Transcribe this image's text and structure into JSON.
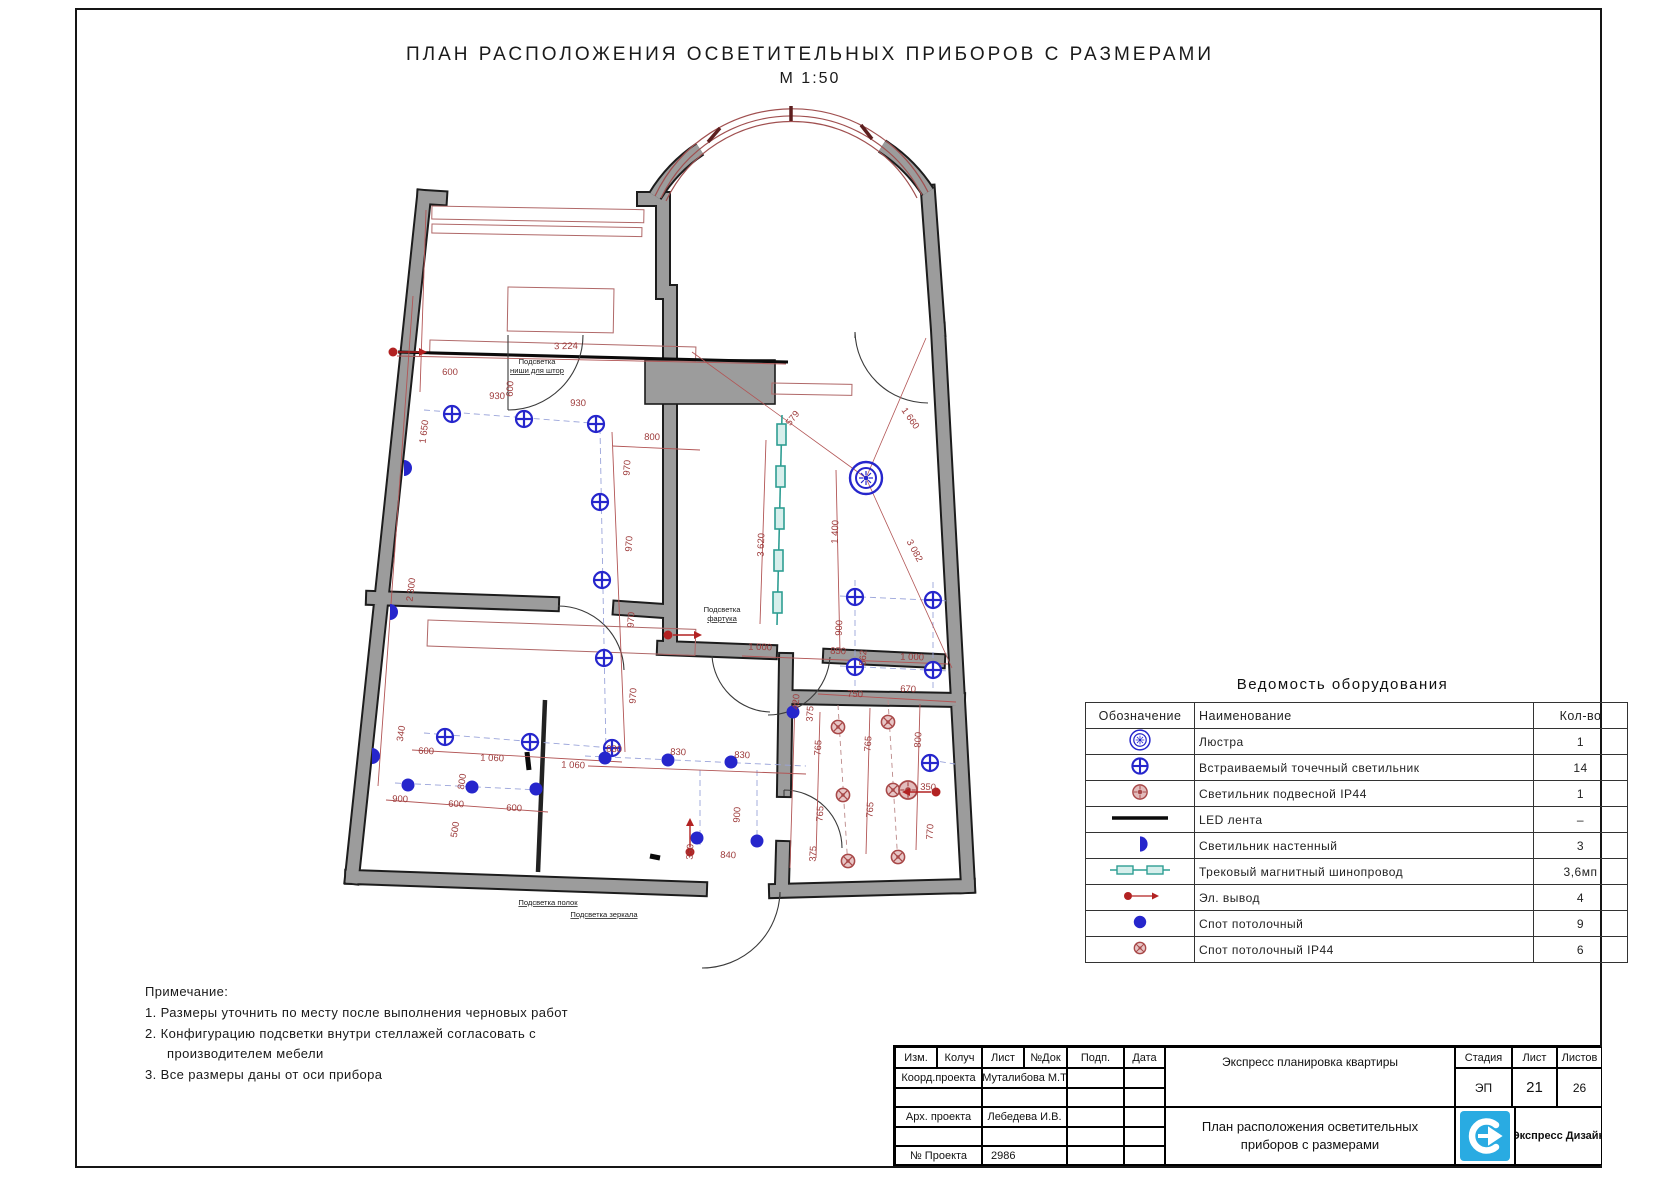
{
  "sheet": {
    "title": "ПЛАН РАСПОЛОЖЕНИЯ ОСВЕТИТЕЛЬНЫХ ПРИБОРОВ С РАЗМЕРАМИ",
    "scale": "М 1:50"
  },
  "colors": {
    "symbol_blue": "#2626cc",
    "dim_red": "#9e3c3c",
    "ip44_red": "#a84848",
    "track_teal": "#2f9e93",
    "wall_gray": "#9c9c9c",
    "logo_blue": "#29abe2"
  },
  "equipment_table": {
    "title": "Ведомость оборудования",
    "columns": [
      "Обозначение",
      "Наименование",
      "Кол-во"
    ],
    "rows": [
      {
        "icon": "chandelier",
        "name": "Люстра",
        "qty": "1"
      },
      {
        "icon": "recessed",
        "name": "Встраиваемый точечный светильник",
        "qty": "14"
      },
      {
        "icon": "pendant-ip44",
        "name": "Светильник подвесной IP44",
        "qty": "1"
      },
      {
        "icon": "led",
        "name": "LED лента",
        "qty": "–"
      },
      {
        "icon": "wall-light",
        "name": "Светильник настенный",
        "qty": "3"
      },
      {
        "icon": "track",
        "name": "Трековый магнитный шинопровод",
        "qty": "3,6мп"
      },
      {
        "icon": "outlet",
        "name": "Эл. вывод",
        "qty": "4"
      },
      {
        "icon": "spot",
        "name": "Спот потолочный",
        "qty": "9"
      },
      {
        "icon": "spot-ip44",
        "name": "Спот потолочный IP44",
        "qty": "6"
      }
    ]
  },
  "notes": {
    "title": "Примечание:",
    "line1": "1. Размеры уточнить по месту после выполнения черновых работ",
    "line2a": "2. Конфигурацию подсветки внутри стеллажей согласовать с",
    "line2b": "производителем мебели",
    "line3": "3. Все размеры даны от оси прибора"
  },
  "title_block": {
    "h1": "Изм.",
    "h2": "Колуч",
    "h3": "Лист",
    "h4": "№Док",
    "h5": "Подп.",
    "h6": "Дата",
    "r2l": "Коорд.проекта",
    "r2v": "Муталибова М.Т",
    "r4l": "Арх. проекта",
    "r4v": "Лебедева И.В.",
    "r6l": "№ Проекта",
    "r6v": "2986",
    "top_title": "Экспресс планировка квартиры",
    "stage": "Стадия",
    "sheet": "Лист",
    "sheets": "Листов",
    "stage_v": "ЭП",
    "sheet_v": "21",
    "sheets_v": "26",
    "doc1": "План расположения осветительных",
    "doc2": "приборов с размерами",
    "brand": "Экспресс Дизайн"
  },
  "plan": {
    "dims": [
      [
        "3 224",
        566,
        349,
        -1
      ],
      [
        "600",
        450,
        375,
        0
      ],
      [
        "930",
        497,
        399,
        1
      ],
      [
        "930",
        578,
        406,
        1
      ],
      [
        "600",
        513,
        389,
        -87
      ],
      [
        "1 650",
        427,
        432,
        -83
      ],
      [
        "800",
        652,
        440,
        1
      ],
      [
        "970",
        630,
        468,
        -86
      ],
      [
        "970",
        632,
        544,
        -86
      ],
      [
        "970",
        634,
        620,
        -86
      ],
      [
        "970",
        636,
        696,
        -86
      ],
      [
        "2 300",
        414,
        590,
        -83
      ],
      [
        "340",
        404,
        734,
        -81
      ],
      [
        "600",
        426,
        754,
        2
      ],
      [
        "1 060",
        492,
        761,
        2
      ],
      [
        "1 060",
        573,
        768,
        2
      ],
      [
        "800",
        465,
        782,
        -81
      ],
      [
        "500",
        458,
        830,
        -81
      ],
      [
        "900",
        400,
        802,
        2
      ],
      [
        "600",
        456,
        807,
        2
      ],
      [
        "600",
        514,
        811,
        2
      ],
      [
        "830",
        614,
        752,
        2
      ],
      [
        "830",
        678,
        755,
        2
      ],
      [
        "830",
        742,
        758,
        2
      ],
      [
        "900",
        740,
        815,
        -86
      ],
      [
        "350",
        693,
        852,
        -86
      ],
      [
        "840",
        728,
        858,
        2
      ],
      [
        "1 000",
        760,
        650,
        2
      ],
      [
        "850",
        838,
        654,
        2
      ],
      [
        "562",
        866,
        658,
        -86
      ],
      [
        "1 000",
        912,
        660,
        2
      ],
      [
        "3 620",
        764,
        545,
        -88
      ],
      [
        "1 400",
        838,
        532,
        -88
      ],
      [
        "900",
        842,
        628,
        -88
      ],
      [
        "579",
        795,
        420,
        -52
      ],
      [
        "1 660",
        908,
        420,
        55
      ],
      [
        "3 082",
        912,
        552,
        62
      ],
      [
        "420",
        799,
        702,
        -86
      ],
      [
        "375",
        813,
        714,
        -86
      ],
      [
        "750",
        855,
        697,
        2
      ],
      [
        "670",
        908,
        692,
        2
      ],
      [
        "765",
        821,
        748,
        -86
      ],
      [
        "765",
        871,
        744,
        -86
      ],
      [
        "800",
        921,
        740,
        -86
      ],
      [
        "765",
        823,
        814,
        -86
      ],
      [
        "765",
        873,
        810,
        -86
      ],
      [
        "350",
        928,
        790,
        2
      ],
      [
        "770",
        933,
        832,
        -86
      ],
      [
        "375",
        816,
        854,
        -86
      ]
    ],
    "labels": [
      {
        "lines": [
          "Подсветка",
          "ниши для штор"
        ],
        "x": 537,
        "y": 364,
        "u": true
      },
      {
        "lines": [
          "Подсветка",
          "фартука"
        ],
        "x": 722,
        "y": 612,
        "u": true
      },
      {
        "lines": [
          "Подсветка полок"
        ],
        "x": 548,
        "y": 905,
        "u": true
      },
      {
        "lines": [
          "Подсветка зеркала"
        ],
        "x": 604,
        "y": 917,
        "u": true
      }
    ],
    "symbols": {
      "recessed": [
        [
          452,
          414
        ],
        [
          524,
          419
        ],
        [
          596,
          424
        ],
        [
          600,
          502
        ],
        [
          602,
          580
        ],
        [
          604,
          658
        ],
        [
          445,
          737
        ],
        [
          530,
          742
        ],
        [
          612,
          748
        ],
        [
          855,
          597
        ],
        [
          933,
          600
        ],
        [
          855,
          667
        ],
        [
          933,
          670
        ],
        [
          930,
          763
        ]
      ],
      "spot": [
        [
          605,
          758
        ],
        [
          668,
          760
        ],
        [
          731,
          762
        ],
        [
          697,
          838
        ],
        [
          757,
          841
        ],
        [
          408,
          785
        ],
        [
          472,
          787
        ],
        [
          536,
          789
        ],
        [
          793,
          712
        ]
      ],
      "spot_ip44": [
        [
          838,
          727
        ],
        [
          888,
          722
        ],
        [
          843,
          795
        ],
        [
          893,
          790
        ],
        [
          848,
          861
        ],
        [
          898,
          857
        ]
      ],
      "pendant_ip44": [
        [
          908,
          790
        ]
      ],
      "chandelier": [
        [
          866,
          478
        ]
      ],
      "wall_light": [
        [
          404,
          468
        ],
        [
          390,
          612
        ],
        [
          372,
          756
        ]
      ],
      "outlet": [
        [
          393,
          352,
          "right"
        ],
        [
          668,
          635,
          "right"
        ],
        [
          690,
          852,
          "up"
        ],
        [
          936,
          792,
          "left"
        ]
      ]
    }
  }
}
